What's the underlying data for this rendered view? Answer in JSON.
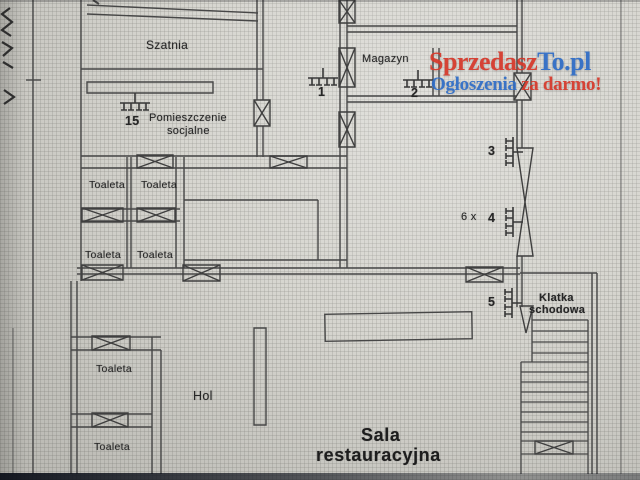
{
  "watermark": {
    "brand_red": "Sprzedasz",
    "brand_blue": "To.pl",
    "tagline_blue": "Ogłoszenia",
    "tagline_red": " za darmo!",
    "color_red": "#d6382a",
    "color_blue": "#2e6cc6"
  },
  "rooms": {
    "szatnia": "Szatnia",
    "magazyn": "Magazyn",
    "socjalne": {
      "line1": "Pomieszczenie",
      "line2": "socjalne"
    },
    "toilets": [
      "Toaleta",
      "Toaleta",
      "Toaleta",
      "Toaleta",
      "Toaleta",
      "Toaleta"
    ],
    "hol": "Hol",
    "klatka": {
      "line1": "Klatka",
      "line2": "schodowa"
    },
    "sala": {
      "line1": "Sala",
      "line2": "restauracyjna"
    }
  },
  "radiators": {
    "r1": "1",
    "r2": "2",
    "r3": "3",
    "r4": "4",
    "r5": "5",
    "r15": "15",
    "quantity_note": "6 x"
  },
  "icons": {
    "door": "door-x-symbol",
    "door_leaf": "door-wedge-symbol",
    "radiator": "radiator-comb-symbol",
    "stairs": "staircase-symbol"
  },
  "line_color": "#474747"
}
